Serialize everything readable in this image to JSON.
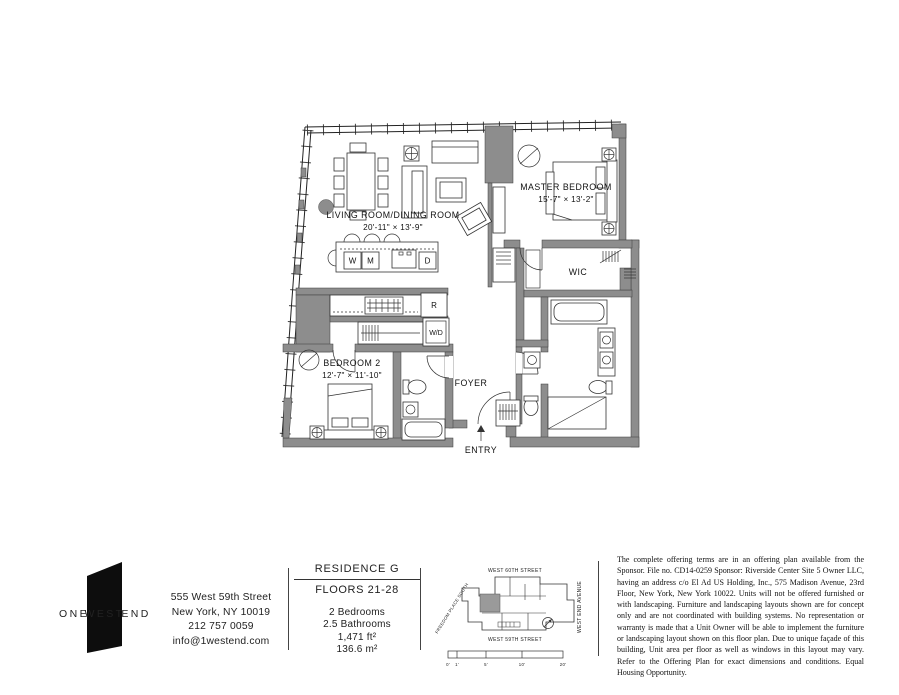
{
  "plan": {
    "rooms": {
      "living": {
        "label": "LIVING ROOM/DINING ROOM",
        "dims": "20'-11\" × 13'-9\""
      },
      "master": {
        "label": "MASTER BEDROOM",
        "dims": "15'-7\" × 13'-2\""
      },
      "bedroom2": {
        "label": "BEDROOM 2",
        "dims": "12'-7\" × 11'-10\""
      },
      "wic": {
        "label": "WIC"
      },
      "foyer": {
        "label": "FOYER"
      },
      "entry": {
        "label": "ENTRY"
      }
    },
    "appliances": {
      "washer": "W",
      "microwave": "M",
      "dishwasher": "D",
      "refrigerator": "R",
      "washer_dryer": "W/D"
    }
  },
  "logo": {
    "one": "ONE",
    "west": "WEST",
    "end": "END"
  },
  "contact": {
    "lines": [
      "555 West 59th Street",
      "New York, NY 10019",
      "212 757 0059",
      "info@1westend.com"
    ]
  },
  "residence": {
    "title": "RESIDENCE G",
    "floors": "FLOORS 21-28",
    "details": [
      "2 Bedrooms",
      "2.5 Bathrooms",
      "1,471 ft²",
      "136.6 m²"
    ]
  },
  "sitemap": {
    "street_top": "WEST 60TH STREET",
    "street_bottom": "WEST 59TH STREET",
    "avenue_right": "WEST END AVENUE",
    "street_left": "FREEDOM PLACE SOUTH",
    "scale_labels": [
      "0'",
      "1'",
      "5'",
      "10'",
      "20'"
    ]
  },
  "legal": {
    "text": "The complete offering terms are in an offering plan available from the Sponsor. File no. CD14-0259 Sponsor: Riverside Center Site 5 Owner LLC, having an address c/o El Ad US Holding, Inc., 575 Madison Avenue, 23rd Floor, New York, New York 10022. Units will not be offered furnished or with landscaping. Furniture and landscaping layouts shown are for concept only and are not coordinated with building systems. No representation or warranty is made that a Unit Owner will be able to implement the furniture or landscaping layout shown on this floor plan. Due to unique façade of this building, Unit area per floor as well as windows in this layout may vary. Refer to the Offering Plan for exact dimensions and conditions.  Equal Housing Opportunity."
  },
  "colors": {
    "wall_poche": "#8d8d8d",
    "line": "#222222",
    "unit_highlight": "#9a9a9a"
  }
}
